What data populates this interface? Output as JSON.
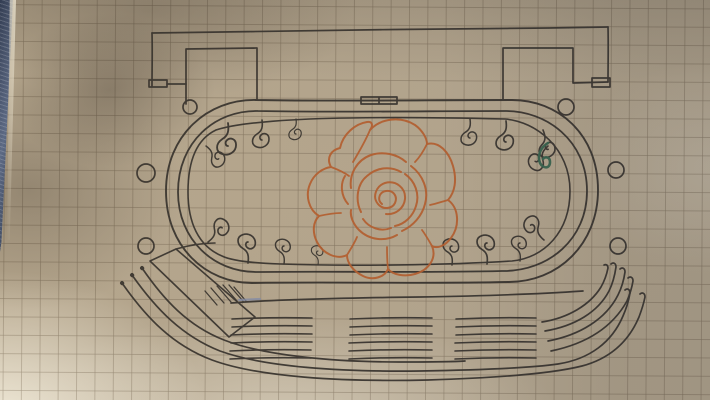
{
  "photo": {
    "type": "photograph",
    "subject": "Hand-drawn plan of an oval track or stadium garden sketched in ink on tan graph paper, photographed at a slight angle",
    "elements": {
      "top_wall": "long wall line across the top joining two rectangular buildings",
      "left_building": "rectangular structure at top left with a small doorway box at its lower-left corner",
      "right_building": "rectangular structure at top right with a small doorway box at its lower-right corner",
      "start_gate": "pair of small rectangles drawn on the oval's top edge at centre",
      "oval_track": "stadium-shaped double outline like a running track",
      "scroll_border": "ocean-wave curl ornaments lining the inside edge of the oval",
      "rose": "large rose with a spiral centre and layered petals drawn in orange ink in the middle of the oval",
      "green_accent": "small dark-green retraced curl on one wave ornament at the upper right",
      "marker_circles": "six small hand-drawn circles outside the oval, three per side",
      "ramp": "slanted hatched ramp shape at the lower left",
      "seating_rows": "rows of bleacher lines with aisle gaps below the oval, sweeping upward at both ends",
      "blue_mark": "faint blue pen smudge on the long lower line",
      "fabric_edge": "dark denim fabric visible along the left edge of the paper"
    },
    "colors": {
      "paper_base": "#b2a48c",
      "paper_highlight": "#e9e2cf",
      "paper_shadow": "#6e6354",
      "grid_line": "#685a48",
      "ink": "#2f2b26",
      "rose_ink": "#b45827",
      "green_ink": "#2e5c46",
      "blue_ink": "#8089a8",
      "denim_dark": "#333d52",
      "denim_light": "#5d6a84"
    }
  }
}
